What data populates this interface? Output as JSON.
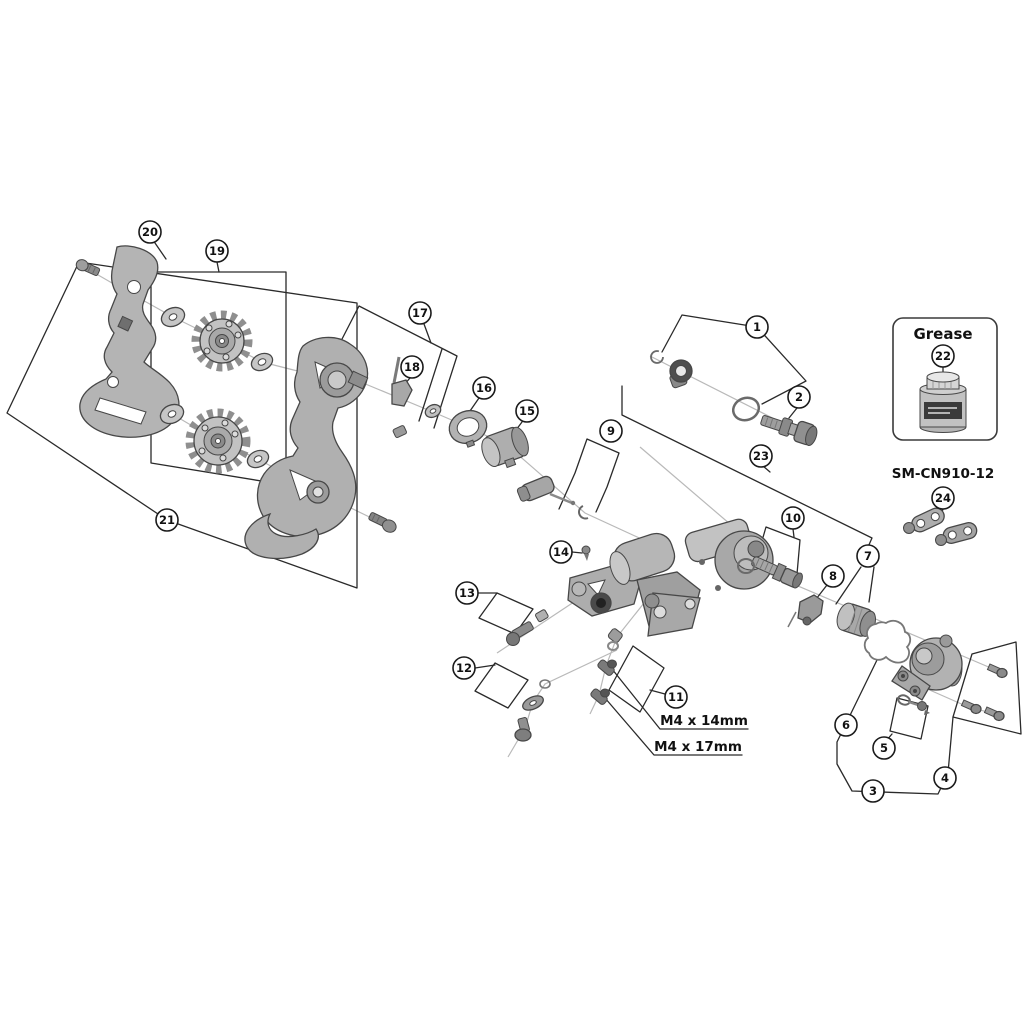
{
  "diagram": {
    "type": "exploded-parts-diagram",
    "background": "#ffffff",
    "line_color": "#2a2a2a",
    "part_fill": "#b0b0b0",
    "labels": {
      "grease": "Grease",
      "chain_model": "SM-CN910-12",
      "screw_spec_1": "M4 x 14mm",
      "screw_spec_2": "M4 x 17mm"
    },
    "callouts": [
      {
        "n": "1",
        "x": 757,
        "y": 327
      },
      {
        "n": "2",
        "x": 799,
        "y": 397
      },
      {
        "n": "3",
        "x": 873,
        "y": 791
      },
      {
        "n": "4",
        "x": 945,
        "y": 778
      },
      {
        "n": "5",
        "x": 884,
        "y": 748
      },
      {
        "n": "6",
        "x": 846,
        "y": 725
      },
      {
        "n": "7",
        "x": 868,
        "y": 556
      },
      {
        "n": "8",
        "x": 833,
        "y": 576
      },
      {
        "n": "9",
        "x": 611,
        "y": 431
      },
      {
        "n": "10",
        "x": 793,
        "y": 518
      },
      {
        "n": "11",
        "x": 676,
        "y": 697
      },
      {
        "n": "12",
        "x": 464,
        "y": 668
      },
      {
        "n": "13",
        "x": 467,
        "y": 593
      },
      {
        "n": "14",
        "x": 561,
        "y": 552
      },
      {
        "n": "15",
        "x": 527,
        "y": 411
      },
      {
        "n": "16",
        "x": 484,
        "y": 388
      },
      {
        "n": "17",
        "x": 420,
        "y": 313
      },
      {
        "n": "18",
        "x": 412,
        "y": 367
      },
      {
        "n": "19",
        "x": 217,
        "y": 251
      },
      {
        "n": "20",
        "x": 150,
        "y": 232
      },
      {
        "n": "21",
        "x": 167,
        "y": 520
      },
      {
        "n": "22",
        "x": 943,
        "y": 356
      },
      {
        "n": "23",
        "x": 761,
        "y": 456
      },
      {
        "n": "24",
        "x": 943,
        "y": 498
      }
    ]
  }
}
